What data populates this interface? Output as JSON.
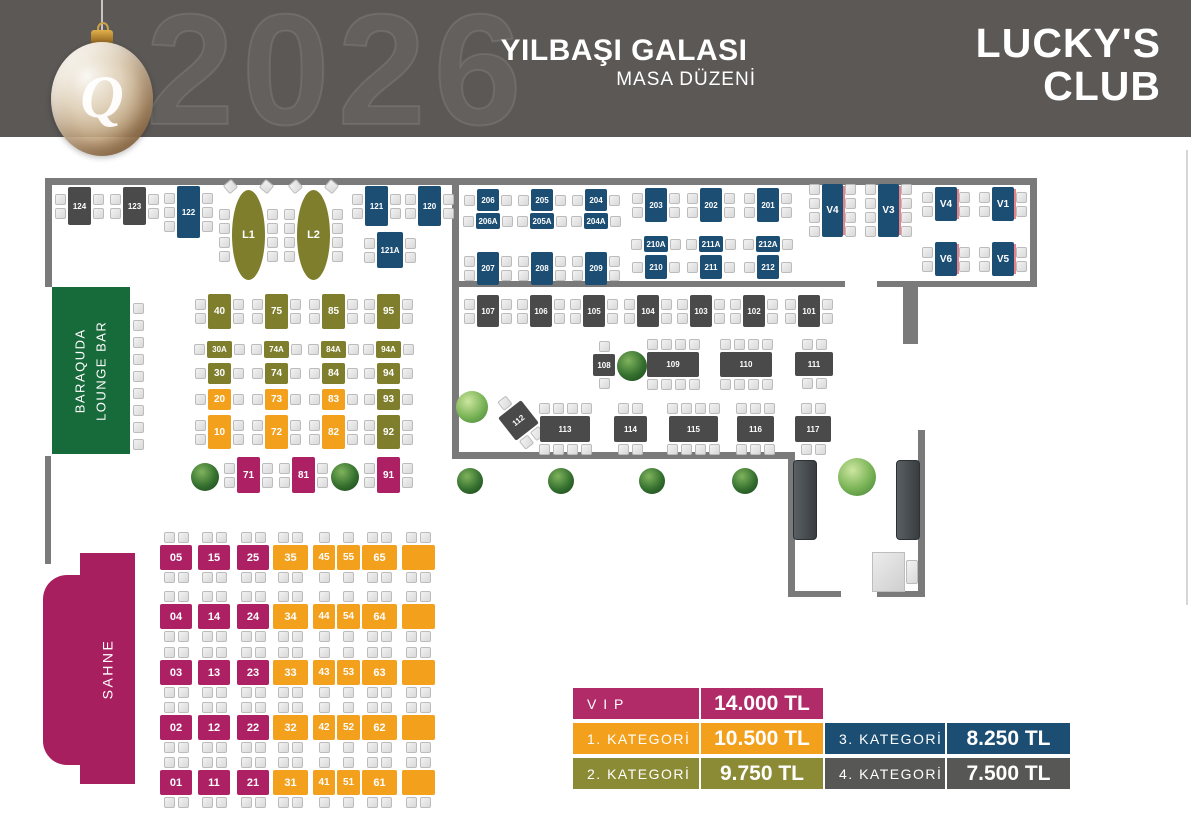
{
  "header": {
    "year_watermark": "2026",
    "title": "YILBAŞI GALASI",
    "subtitle": "MASA DÜZENİ",
    "brand_line1": "LUCKY'S",
    "brand_line2": "CLUB",
    "ornament_letter": "Q"
  },
  "areas": {
    "lounge_line1": "BARAQUDA",
    "lounge_line2": "LOUNGE BAR",
    "stage": "SAHNE"
  },
  "palette": {
    "header_bg": "#5b5856",
    "wall": "#7a7a7a",
    "vip": "#ad2164",
    "kategori1": "#f3a01d",
    "kategori2": "#7e7e2d",
    "kategori3": "#1c4e74",
    "kategori4": "#4a4a4a",
    "lounge_green": "#176a39",
    "stage_magenta": "#a81f60"
  },
  "legend": {
    "left": [
      {
        "label": "V I P",
        "price": "14.000 TL",
        "color": "#b02b68"
      },
      {
        "label": "1.  KATEGORİ",
        "price": "10.500 TL",
        "color": "#f3a01d"
      },
      {
        "label": "2.  KATEGORİ",
        "price": "9.750 TL",
        "color": "#8b8b35"
      }
    ],
    "right": [
      {
        "label": "3.  KATEGORİ",
        "price": "8.250 TL",
        "color": "#1c4e74"
      },
      {
        "label": "4.  KATEGORİ",
        "price": "7.500 TL",
        "color": "#575756"
      }
    ]
  },
  "walls": [
    {
      "x": 45,
      "y": 178,
      "w": 992,
      "h": 7
    },
    {
      "x": 45,
      "y": 185,
      "w": 7,
      "h": 102
    },
    {
      "x": 452,
      "y": 185,
      "w": 7,
      "h": 274
    },
    {
      "x": 1030,
      "y": 185,
      "w": 7,
      "h": 96
    },
    {
      "x": 452,
      "y": 281,
      "w": 393,
      "h": 6
    },
    {
      "x": 877,
      "y": 281,
      "w": 160,
      "h": 6
    },
    {
      "x": 903,
      "y": 287,
      "w": 15,
      "h": 57
    },
    {
      "x": 45,
      "y": 456,
      "w": 6,
      "h": 108
    },
    {
      "x": 455,
      "y": 452,
      "w": 340,
      "h": 7
    },
    {
      "x": 788,
      "y": 459,
      "w": 7,
      "h": 138
    },
    {
      "x": 788,
      "y": 591,
      "w": 53,
      "h": 6
    },
    {
      "x": 877,
      "y": 591,
      "w": 48,
      "h": 6
    },
    {
      "x": 918,
      "y": 430,
      "w": 7,
      "h": 167
    }
  ],
  "edge_line": {
    "x": 1186,
    "y": 150,
    "w": 2,
    "h": 455
  },
  "trees": [
    {
      "x": 205,
      "y": 477,
      "r": 14,
      "shade": "dark"
    },
    {
      "x": 345,
      "y": 477,
      "r": 14,
      "shade": "dark"
    },
    {
      "x": 632,
      "y": 366,
      "r": 15,
      "shade": "dark"
    },
    {
      "x": 472,
      "y": 407,
      "r": 16,
      "shade": "light"
    },
    {
      "x": 470,
      "y": 481,
      "r": 13,
      "shade": "dark"
    },
    {
      "x": 561,
      "y": 481,
      "r": 13,
      "shade": "dark"
    },
    {
      "x": 652,
      "y": 481,
      "r": 13,
      "shade": "dark"
    },
    {
      "x": 745,
      "y": 481,
      "r": 13,
      "shade": "dark"
    },
    {
      "x": 857,
      "y": 477,
      "r": 19,
      "shade": "light"
    }
  ],
  "furniture": {
    "doors": [
      {
        "x": 793,
        "y": 460,
        "w": 22,
        "h": 78
      },
      {
        "x": 896,
        "y": 460,
        "w": 22,
        "h": 78
      }
    ],
    "desk": {
      "x": 872,
      "y": 552,
      "w": 31,
      "h": 38
    },
    "desk_chair": {
      "x": 906,
      "y": 560,
      "w": 12,
      "h": 24
    },
    "bar_stools": {
      "x": 133,
      "y": 303,
      "count": 9,
      "step": 17
    }
  },
  "tables": [
    {
      "id": "124",
      "x": 68,
      "y": 187,
      "w": 23,
      "h": 38,
      "cat": "k4",
      "ch": {
        "l": 2,
        "r": 2
      }
    },
    {
      "id": "123",
      "x": 123,
      "y": 187,
      "w": 23,
      "h": 38,
      "cat": "k4",
      "ch": {
        "l": 2,
        "r": 2
      }
    },
    {
      "id": "122",
      "x": 177,
      "y": 186,
      "w": 23,
      "h": 52,
      "cat": "k3",
      "ch": {
        "l": 3,
        "r": 3
      }
    },
    {
      "id": "121",
      "x": 365,
      "y": 186,
      "w": 23,
      "h": 40,
      "cat": "k3",
      "ch": {
        "l": 2,
        "r": 2
      }
    },
    {
      "id": "120",
      "x": 418,
      "y": 186,
      "w": 23,
      "h": 40,
      "cat": "k3",
      "ch": {
        "l": 2,
        "r": 2
      }
    },
    {
      "id": "121A",
      "x": 377,
      "y": 232,
      "w": 26,
      "h": 36,
      "cat": "k3",
      "ch": {
        "l": 2,
        "r": 2
      }
    },
    {
      "id": "L1",
      "x": 232,
      "y": 190,
      "w": 33,
      "h": 90,
      "cat": "k2",
      "shape": "oval",
      "ch": {
        "l": 4,
        "r": 4,
        "dt": 1
      }
    },
    {
      "id": "L2",
      "x": 297,
      "y": 190,
      "w": 33,
      "h": 90,
      "cat": "k2",
      "shape": "oval",
      "ch": {
        "l": 4,
        "r": 4,
        "dt": 1
      }
    },
    {
      "id": "206",
      "x": 477,
      "y": 189,
      "w": 22,
      "h": 22,
      "cat": "k3",
      "ch": {
        "l": 1,
        "r": 1
      }
    },
    {
      "id": "205",
      "x": 531,
      "y": 189,
      "w": 22,
      "h": 22,
      "cat": "k3",
      "ch": {
        "l": 1,
        "r": 1
      }
    },
    {
      "id": "204",
      "x": 585,
      "y": 189,
      "w": 22,
      "h": 22,
      "cat": "k3",
      "ch": {
        "l": 1,
        "r": 1
      }
    },
    {
      "id": "206A",
      "x": 476,
      "y": 213,
      "w": 24,
      "h": 16,
      "cat": "k3",
      "ch": {
        "l": 1,
        "r": 1
      }
    },
    {
      "id": "205A",
      "x": 530,
      "y": 213,
      "w": 24,
      "h": 16,
      "cat": "k3",
      "ch": {
        "l": 1,
        "r": 1
      }
    },
    {
      "id": "204A",
      "x": 584,
      "y": 213,
      "w": 24,
      "h": 16,
      "cat": "k3",
      "ch": {
        "l": 1,
        "r": 1
      }
    },
    {
      "id": "203",
      "x": 645,
      "y": 188,
      "w": 22,
      "h": 34,
      "cat": "k3",
      "ch": {
        "l": 2,
        "r": 2
      }
    },
    {
      "id": "202",
      "x": 700,
      "y": 188,
      "w": 22,
      "h": 34,
      "cat": "k3",
      "ch": {
        "l": 2,
        "r": 2
      }
    },
    {
      "id": "201",
      "x": 757,
      "y": 188,
      "w": 22,
      "h": 34,
      "cat": "k3",
      "ch": {
        "l": 2,
        "r": 2
      }
    },
    {
      "id": "207",
      "x": 477,
      "y": 252,
      "w": 22,
      "h": 33,
      "cat": "k3",
      "ch": {
        "l": 2,
        "r": 2
      }
    },
    {
      "id": "208",
      "x": 531,
      "y": 252,
      "w": 22,
      "h": 33,
      "cat": "k3",
      "ch": {
        "l": 2,
        "r": 2
      }
    },
    {
      "id": "209",
      "x": 585,
      "y": 252,
      "w": 22,
      "h": 33,
      "cat": "k3",
      "ch": {
        "l": 2,
        "r": 2
      }
    },
    {
      "id": "210A",
      "x": 644,
      "y": 236,
      "w": 24,
      "h": 16,
      "cat": "k3",
      "ch": {
        "l": 1,
        "r": 1
      }
    },
    {
      "id": "210",
      "x": 645,
      "y": 255,
      "w": 22,
      "h": 24,
      "cat": "k3",
      "ch": {
        "l": 1,
        "r": 1
      }
    },
    {
      "id": "211A",
      "x": 699,
      "y": 236,
      "w": 24,
      "h": 16,
      "cat": "k3",
      "ch": {
        "l": 1,
        "r": 1
      }
    },
    {
      "id": "211",
      "x": 700,
      "y": 255,
      "w": 22,
      "h": 24,
      "cat": "k3",
      "ch": {
        "l": 1,
        "r": 1
      }
    },
    {
      "id": "212A",
      "x": 756,
      "y": 236,
      "w": 24,
      "h": 16,
      "cat": "k3",
      "ch": {
        "l": 1,
        "r": 1
      }
    },
    {
      "id": "212",
      "x": 757,
      "y": 255,
      "w": 22,
      "h": 24,
      "cat": "k3",
      "ch": {
        "l": 1,
        "r": 1
      }
    },
    {
      "id": "V4",
      "x": 822,
      "y": 184,
      "w": 21,
      "h": 53,
      "cat": "k3",
      "edge": true,
      "ch": {
        "l": 4,
        "r": 4
      }
    },
    {
      "id": "V3",
      "x": 878,
      "y": 184,
      "w": 21,
      "h": 53,
      "cat": "k3",
      "edge": true,
      "ch": {
        "l": 4,
        "r": 4
      }
    },
    {
      "id": "V4",
      "x": 935,
      "y": 187,
      "w": 22,
      "h": 34,
      "cat": "k3",
      "edge": true,
      "ch": {
        "l": 2,
        "r": 2
      }
    },
    {
      "id": "V1",
      "x": 992,
      "y": 187,
      "w": 22,
      "h": 34,
      "cat": "k3",
      "edge": true,
      "ch": {
        "l": 2,
        "r": 2
      }
    },
    {
      "id": "V6",
      "x": 935,
      "y": 242,
      "w": 22,
      "h": 34,
      "cat": "k3",
      "edge": true,
      "ch": {
        "l": 2,
        "r": 2
      }
    },
    {
      "id": "V5",
      "x": 992,
      "y": 242,
      "w": 22,
      "h": 34,
      "cat": "k3",
      "edge": true,
      "ch": {
        "l": 2,
        "r": 2
      }
    },
    {
      "id": "107",
      "x": 477,
      "y": 295,
      "w": 22,
      "h": 32,
      "cat": "k4",
      "ch": {
        "l": 2,
        "r": 2
      }
    },
    {
      "id": "106",
      "x": 530,
      "y": 295,
      "w": 22,
      "h": 32,
      "cat": "k4",
      "ch": {
        "l": 2,
        "r": 2
      }
    },
    {
      "id": "105",
      "x": 583,
      "y": 295,
      "w": 22,
      "h": 32,
      "cat": "k4",
      "ch": {
        "l": 2,
        "r": 2
      }
    },
    {
      "id": "104",
      "x": 637,
      "y": 295,
      "w": 22,
      "h": 32,
      "cat": "k4",
      "ch": {
        "l": 2,
        "r": 2
      }
    },
    {
      "id": "103",
      "x": 690,
      "y": 295,
      "w": 22,
      "h": 32,
      "cat": "k4",
      "ch": {
        "l": 2,
        "r": 2
      }
    },
    {
      "id": "102",
      "x": 743,
      "y": 295,
      "w": 22,
      "h": 32,
      "cat": "k4",
      "ch": {
        "l": 2,
        "r": 2
      }
    },
    {
      "id": "101",
      "x": 798,
      "y": 295,
      "w": 22,
      "h": 32,
      "cat": "k4",
      "ch": {
        "l": 2,
        "r": 2
      }
    },
    {
      "id": "108",
      "x": 593,
      "y": 354,
      "w": 22,
      "h": 22,
      "cat": "k4",
      "ch": {
        "t": 1,
        "b": 1
      }
    },
    {
      "id": "109",
      "x": 647,
      "y": 352,
      "w": 52,
      "h": 25,
      "cat": "k4",
      "ch": {
        "t": 4,
        "b": 4
      }
    },
    {
      "id": "110",
      "x": 720,
      "y": 352,
      "w": 52,
      "h": 25,
      "cat": "k4",
      "ch": {
        "t": 4,
        "b": 4
      }
    },
    {
      "id": "111",
      "x": 795,
      "y": 352,
      "w": 38,
      "h": 24,
      "cat": "k4",
      "ch": {
        "t": 2,
        "b": 2
      }
    },
    {
      "id": "112",
      "x": 504,
      "y": 406,
      "w": 29,
      "h": 29,
      "cat": "k4",
      "rot": -38,
      "ch": {
        "t": 1,
        "b": 2
      }
    },
    {
      "id": "113",
      "x": 540,
      "y": 416,
      "w": 50,
      "h": 26,
      "cat": "k4",
      "ch": {
        "t": 4,
        "b": 4
      }
    },
    {
      "id": "114",
      "x": 614,
      "y": 416,
      "w": 33,
      "h": 26,
      "cat": "k4",
      "ch": {
        "t": 2,
        "b": 2
      }
    },
    {
      "id": "115",
      "x": 669,
      "y": 416,
      "w": 49,
      "h": 26,
      "cat": "k4",
      "ch": {
        "t": 4,
        "b": 4
      }
    },
    {
      "id": "116",
      "x": 737,
      "y": 416,
      "w": 37,
      "h": 26,
      "cat": "k4",
      "ch": {
        "t": 3,
        "b": 3
      }
    },
    {
      "id": "117",
      "x": 795,
      "y": 416,
      "w": 36,
      "h": 26,
      "cat": "k4",
      "ch": {
        "t": 2,
        "b": 2
      }
    },
    {
      "id": "40",
      "x": 208,
      "y": 294,
      "w": 23,
      "h": 35,
      "cat": "k2",
      "ch": {
        "l": 2,
        "r": 2
      }
    },
    {
      "id": "75",
      "x": 265,
      "y": 294,
      "w": 23,
      "h": 35,
      "cat": "k2",
      "ch": {
        "l": 2,
        "r": 2
      }
    },
    {
      "id": "85",
      "x": 322,
      "y": 294,
      "w": 23,
      "h": 35,
      "cat": "k2",
      "ch": {
        "l": 2,
        "r": 2
      }
    },
    {
      "id": "95",
      "x": 377,
      "y": 294,
      "w": 23,
      "h": 35,
      "cat": "k2",
      "ch": {
        "l": 2,
        "r": 2
      }
    },
    {
      "id": "30A",
      "x": 207,
      "y": 341,
      "w": 25,
      "h": 17,
      "cat": "k2",
      "ch": {
        "l": 1,
        "r": 1
      }
    },
    {
      "id": "74A",
      "x": 264,
      "y": 341,
      "w": 25,
      "h": 17,
      "cat": "k2",
      "ch": {
        "l": 1,
        "r": 1
      }
    },
    {
      "id": "84A",
      "x": 321,
      "y": 341,
      "w": 25,
      "h": 17,
      "cat": "k2",
      "ch": {
        "l": 1,
        "r": 1
      }
    },
    {
      "id": "94A",
      "x": 376,
      "y": 341,
      "w": 25,
      "h": 17,
      "cat": "k2",
      "ch": {
        "l": 1,
        "r": 1
      }
    },
    {
      "id": "30",
      "x": 208,
      "y": 363,
      "w": 23,
      "h": 21,
      "cat": "k2",
      "ch": {
        "l": 1,
        "r": 1
      }
    },
    {
      "id": "74",
      "x": 265,
      "y": 363,
      "w": 23,
      "h": 21,
      "cat": "k2",
      "ch": {
        "l": 1,
        "r": 1
      }
    },
    {
      "id": "84",
      "x": 322,
      "y": 363,
      "w": 23,
      "h": 21,
      "cat": "k2",
      "ch": {
        "l": 1,
        "r": 1
      }
    },
    {
      "id": "94",
      "x": 377,
      "y": 363,
      "w": 23,
      "h": 21,
      "cat": "k2",
      "ch": {
        "l": 1,
        "r": 1
      }
    },
    {
      "id": "20",
      "x": 208,
      "y": 389,
      "w": 23,
      "h": 21,
      "cat": "k1",
      "ch": {
        "l": 1,
        "r": 1
      }
    },
    {
      "id": "73",
      "x": 265,
      "y": 389,
      "w": 23,
      "h": 21,
      "cat": "k1",
      "ch": {
        "l": 1,
        "r": 1
      }
    },
    {
      "id": "83",
      "x": 322,
      "y": 389,
      "w": 23,
      "h": 21,
      "cat": "k1",
      "ch": {
        "l": 1,
        "r": 1
      }
    },
    {
      "id": "93",
      "x": 377,
      "y": 389,
      "w": 23,
      "h": 21,
      "cat": "k2",
      "ch": {
        "l": 1,
        "r": 1
      }
    },
    {
      "id": "10",
      "x": 208,
      "y": 415,
      "w": 23,
      "h": 34,
      "cat": "k1",
      "ch": {
        "l": 2,
        "r": 2
      }
    },
    {
      "id": "72",
      "x": 265,
      "y": 415,
      "w": 23,
      "h": 34,
      "cat": "k1",
      "ch": {
        "l": 2,
        "r": 2
      }
    },
    {
      "id": "82",
      "x": 322,
      "y": 415,
      "w": 23,
      "h": 34,
      "cat": "k1",
      "ch": {
        "l": 2,
        "r": 2
      }
    },
    {
      "id": "92",
      "x": 377,
      "y": 415,
      "w": 23,
      "h": 34,
      "cat": "k2",
      "ch": {
        "l": 2,
        "r": 2
      }
    },
    {
      "id": "71",
      "x": 237,
      "y": 457,
      "w": 23,
      "h": 36,
      "cat": "vip",
      "ch": {
        "l": 2,
        "r": 2
      }
    },
    {
      "id": "81",
      "x": 292,
      "y": 457,
      "w": 23,
      "h": 36,
      "cat": "vip",
      "ch": {
        "l": 2,
        "r": 2
      }
    },
    {
      "id": "91",
      "x": 377,
      "y": 457,
      "w": 23,
      "h": 36,
      "cat": "vip",
      "ch": {
        "l": 2,
        "r": 2
      }
    }
  ],
  "grid": {
    "h": 25,
    "cols": [
      {
        "x": 160,
        "w": 32
      },
      {
        "x": 198,
        "w": 32
      },
      {
        "x": 237,
        "w": 32
      },
      {
        "x": 273,
        "w": 35
      },
      {
        "x": 313,
        "w": 22
      },
      {
        "x": 337,
        "w": 23
      },
      {
        "x": 362,
        "w": 35
      },
      {
        "x": 402,
        "w": 33
      }
    ],
    "rows": [
      {
        "y": 545
      },
      {
        "y": 604
      },
      {
        "y": 660
      },
      {
        "y": 715
      },
      {
        "y": 770
      }
    ],
    "ids": [
      [
        "05",
        "15",
        "25",
        "35",
        "45",
        "55",
        "65",
        ""
      ],
      [
        "04",
        "14",
        "24",
        "34",
        "44",
        "54",
        "64",
        ""
      ],
      [
        "03",
        "13",
        "23",
        "33",
        "43",
        "53",
        "63",
        ""
      ],
      [
        "02",
        "12",
        "22",
        "32",
        "42",
        "52",
        "62",
        ""
      ],
      [
        "01",
        "11",
        "21",
        "31",
        "41",
        "51",
        "61",
        ""
      ]
    ]
  }
}
